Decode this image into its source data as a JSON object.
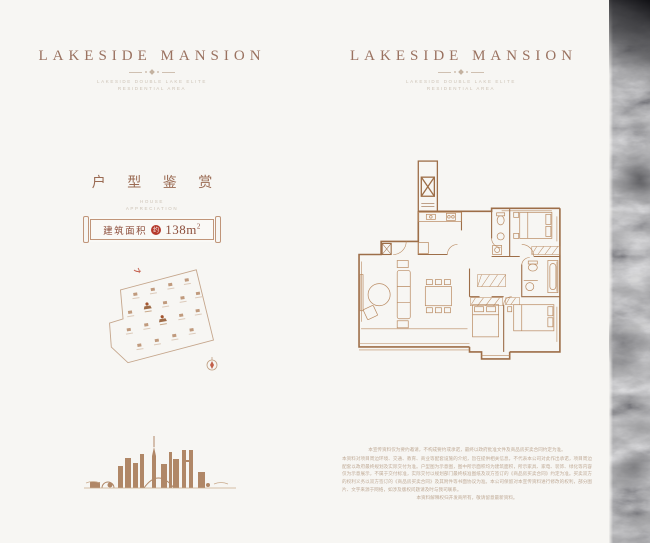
{
  "colors": {
    "background": "#f7f6f3",
    "brand_text": "#9a7260",
    "section_text": "#9a6a52",
    "badge_text": "#8d4f3c",
    "seal_red": "#b5392b",
    "plan_wall": "#9d6e48",
    "plan_furniture": "#b98a61",
    "site_line": "#c5a68c",
    "skyline_brown": "#ae8161",
    "muted_caption": "#cdc3b6",
    "disclaimer_text": "#c0ab97"
  },
  "left_panel": {
    "brand": {
      "title": "LAKESIDE  MANSION",
      "subtitle_line1": "LAKESIDE DOUBLE LAKE ELITE",
      "subtitle_line2": "RESIDENTIAL AREA"
    },
    "section": {
      "title": "户 型 鉴 赏",
      "subtitle_line1": "HOUSE",
      "subtitle_line2": "APPRECIATION"
    },
    "area_badge": {
      "label": "建筑面积",
      "seal": "约",
      "value": "138m",
      "value_sup": "2"
    }
  },
  "right_panel": {
    "brand": {
      "title": "LAKESIDE  MANSION",
      "subtitle_line1": "LAKESIDE DOUBLE LAKE ELITE",
      "subtitle_line2": "RESIDENTIAL AREA"
    },
    "disclaimer": {
      "line_top": "本宣传资料仅为要约邀请，不构成要约或承诺，最终以政府批准文件及商品房买卖合同约定为准。",
      "body": "本资料对项目周边环境、交通、教育、商业等配套设施的介绍，旨在提供相关信息，不代表本公司对此作出承诺，项目周边配套以政府最终规划及实际交付为准。户型图为示意图，图中所示面积均为建筑面积，所示家具、家电、装饰、绿化等内容仅为示意展示，不属于交付标准，实际交付以规划部门最终核准图纸及双方签订的《商品房买卖合同》约定为准。买卖双方的权利义务以双方签订的《商品房买卖合同》及其附件等书面协议为准。本公司保留对本宣传资料进行修改的权利，部分图片、文字来源于网络，如涉及版权问题请及时与我司联系。",
      "line_bottom": "本资料解释权归开发商所有，敬请留意最新资料。"
    }
  }
}
